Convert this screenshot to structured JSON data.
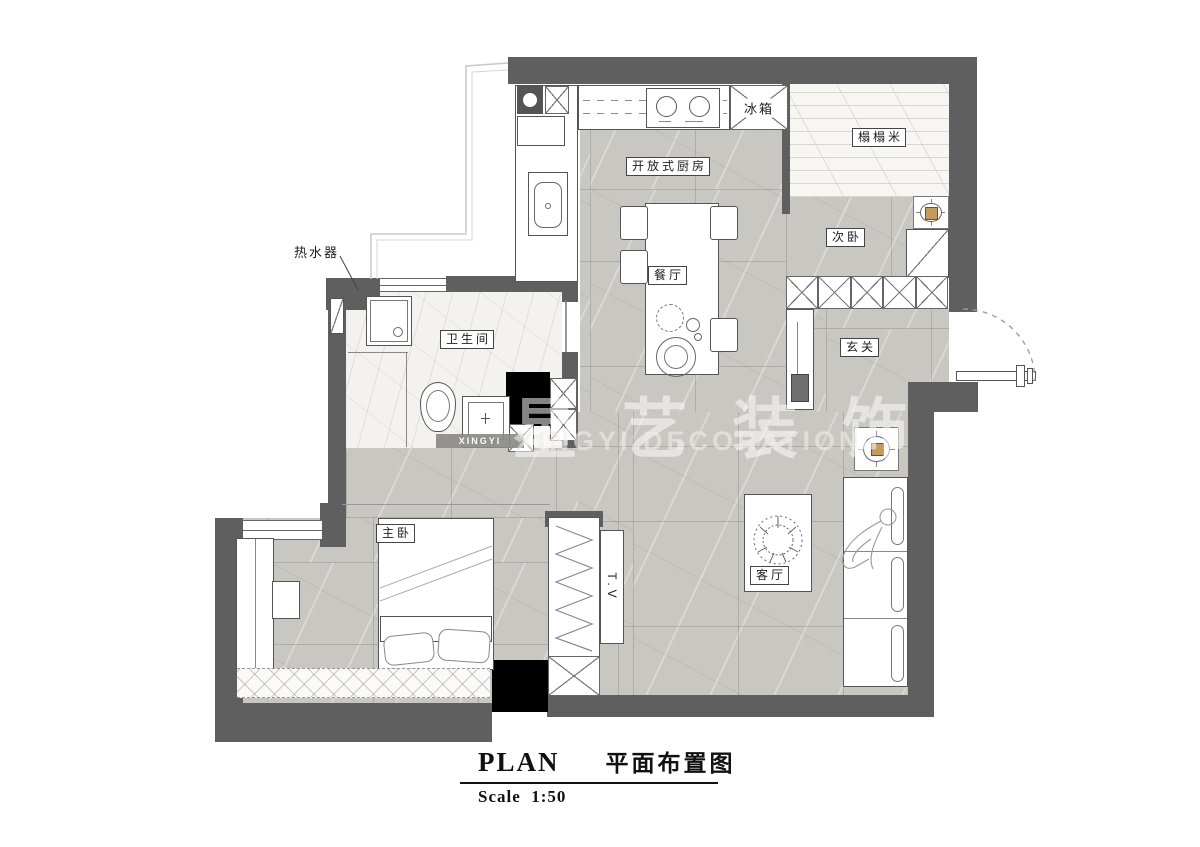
{
  "title_block": {
    "plan_en": "PLAN",
    "plan_zh": "平面布置图",
    "scale": "Scale  1:50"
  },
  "watermark": {
    "zh": "星艺装饰",
    "en": "XINGYI DECORATION",
    "ribbon": "XINGYI"
  },
  "rooms": {
    "open_kitchen": "开放式厨房",
    "dining": "餐厅",
    "tatami": "榻榻米",
    "second_bedroom": "次卧",
    "entry": "玄关",
    "bathroom": "卫生间",
    "master_bedroom": "主卧",
    "living_room": "客厅"
  },
  "annotations": {
    "fridge": "冰箱",
    "water_heater": "热水器",
    "tv": "T.V"
  },
  "colors": {
    "wall": "#5f5f5f",
    "floor_tile": "#c9c7c2",
    "marble": "#f4f2ee",
    "light_fixture_accent": "#c49a5e",
    "shaft_black": "#000000",
    "line": "#555555"
  }
}
